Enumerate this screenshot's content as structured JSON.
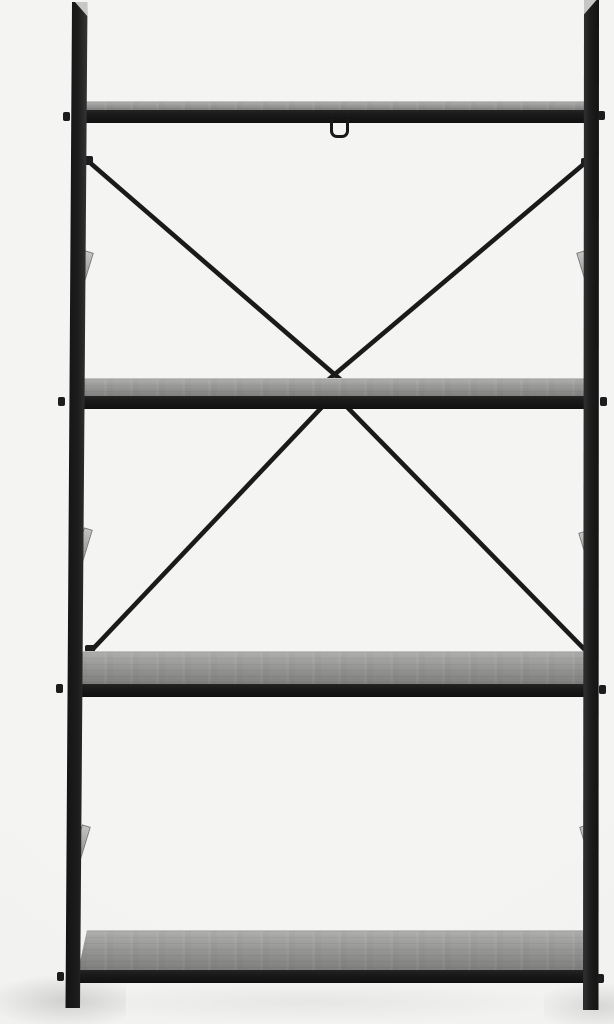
{
  "scene": {
    "description": "Studio product photo of a black metal ladder-style shelving unit with four grey wood-grain shelves, X-shaped cross bracing at the back crossing at the second shelf, a small wire hanging hook under the top shelf, bolt stubs at the rail ends, beveled post tops, and soft floor shadows on a seamless light grey background.",
    "shelf_count": "4"
  },
  "colors": {
    "bg": "#f4f4f3",
    "frame": "#1a1a1a",
    "bevel": "#c7c7c5",
    "wood-a": "#aeaeac",
    "wood-b": "#979795",
    "wood-c": "#7d7d7b",
    "wood-edge": "#c2c2c0",
    "wedge-light": "#c3c3c1",
    "wedge-dark": "#8b8b89"
  }
}
